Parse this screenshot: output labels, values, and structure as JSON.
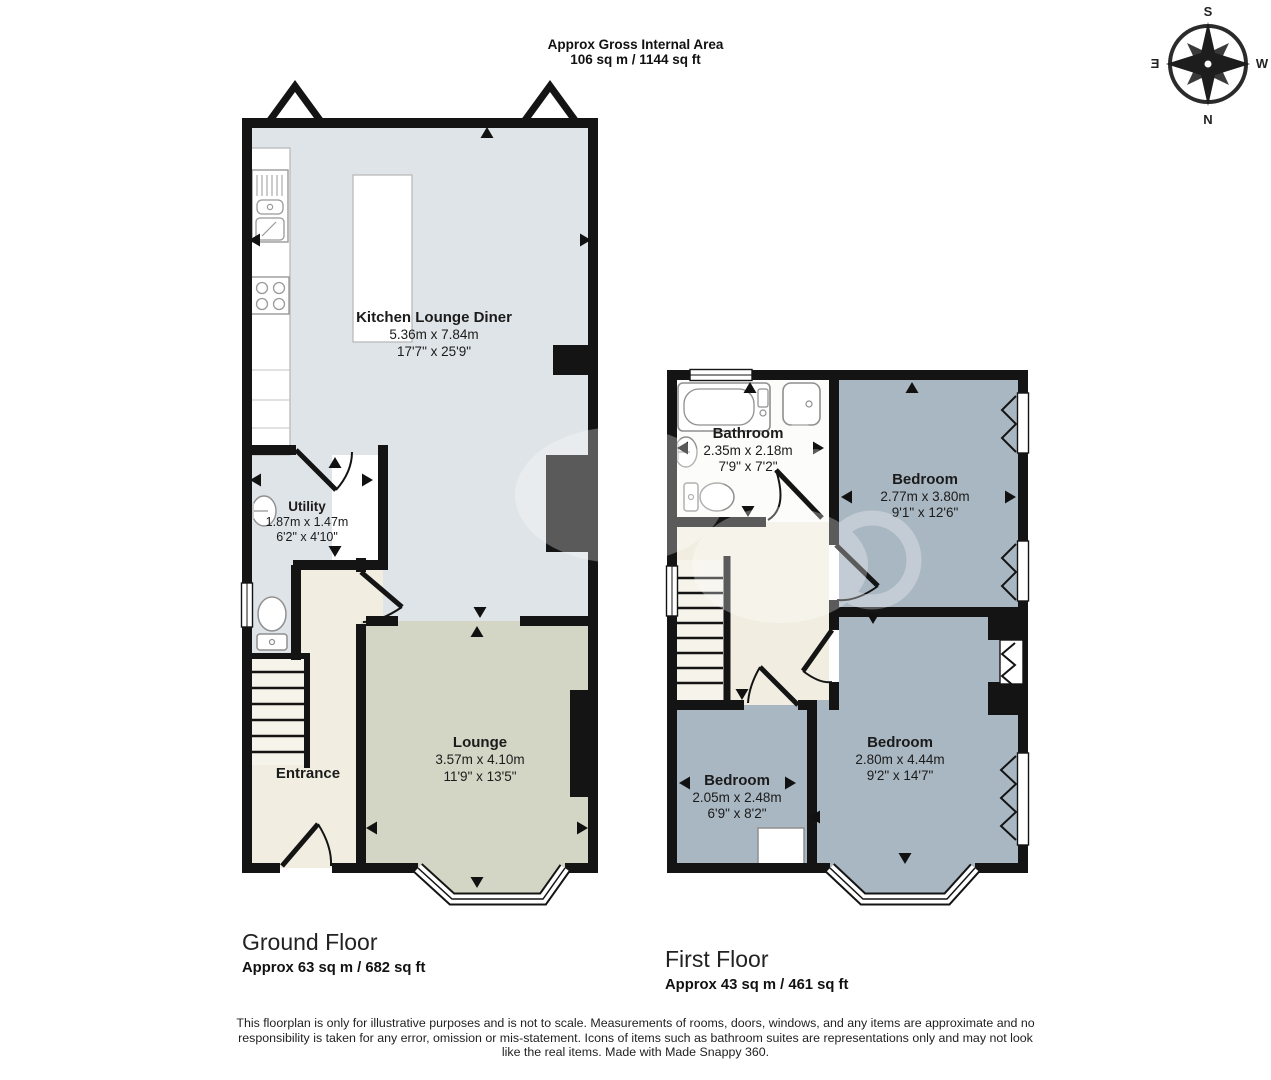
{
  "header": {
    "line1": "Approx Gross Internal Area",
    "line2": "106 sq m / 1144 sq ft"
  },
  "compass": {
    "top": "S",
    "bottom": "N",
    "left": "E",
    "right": "W"
  },
  "floors": {
    "ground": {
      "title": "Ground Floor",
      "area": "Approx 63 sq m / 682 sq ft",
      "rooms": {
        "kitchen_lounge_diner": {
          "name": "Kitchen Lounge Diner",
          "metric": "5.36m x 7.84m",
          "imperial": "17'7\" x 25'9\""
        },
        "utility": {
          "name": "Utility",
          "metric": "1.87m x 1.47m",
          "imperial": "6'2\" x 4'10\""
        },
        "entrance": {
          "name": "Entrance"
        },
        "lounge": {
          "name": "Lounge",
          "metric": "3.57m x 4.10m",
          "imperial": "11'9\" x 13'5\""
        }
      }
    },
    "first": {
      "title": "First Floor",
      "area": "Approx 43 sq m / 461 sq ft",
      "rooms": {
        "bathroom": {
          "name": "Bathroom",
          "metric": "2.35m x 2.18m",
          "imperial": "7'9\" x 7'2\""
        },
        "bedroom_front": {
          "name": "Bedroom",
          "metric": "2.77m x 3.80m",
          "imperial": "9'1\" x 12'6\""
        },
        "bedroom_small": {
          "name": "Bedroom",
          "metric": "2.05m x 2.48m",
          "imperial": "6'9\" x 8'2\""
        },
        "bedroom_large": {
          "name": "Bedroom",
          "metric": "2.80m x 4.44m",
          "imperial": "9'2\" x 14'7\""
        }
      }
    }
  },
  "footer": {
    "disclaimer": "This floorplan is only for illustrative purposes and is not to scale. Measurements of rooms, doors, windows, and any items are approximate and no responsibility is taken for any error, omission or mis-statement. Icons of items such as bathroom suites are representations only and may not look like the real items. Made with Made Snappy 360."
  },
  "colors": {
    "wall": "#141414",
    "kitchen_fill": "#dfe4e8",
    "lounge_fill": "#d4d6c5",
    "hall_fill": "#f1eee1",
    "bedroom_fill": "#a9b7c2",
    "bathroom_fill": "#fcfcfa"
  }
}
